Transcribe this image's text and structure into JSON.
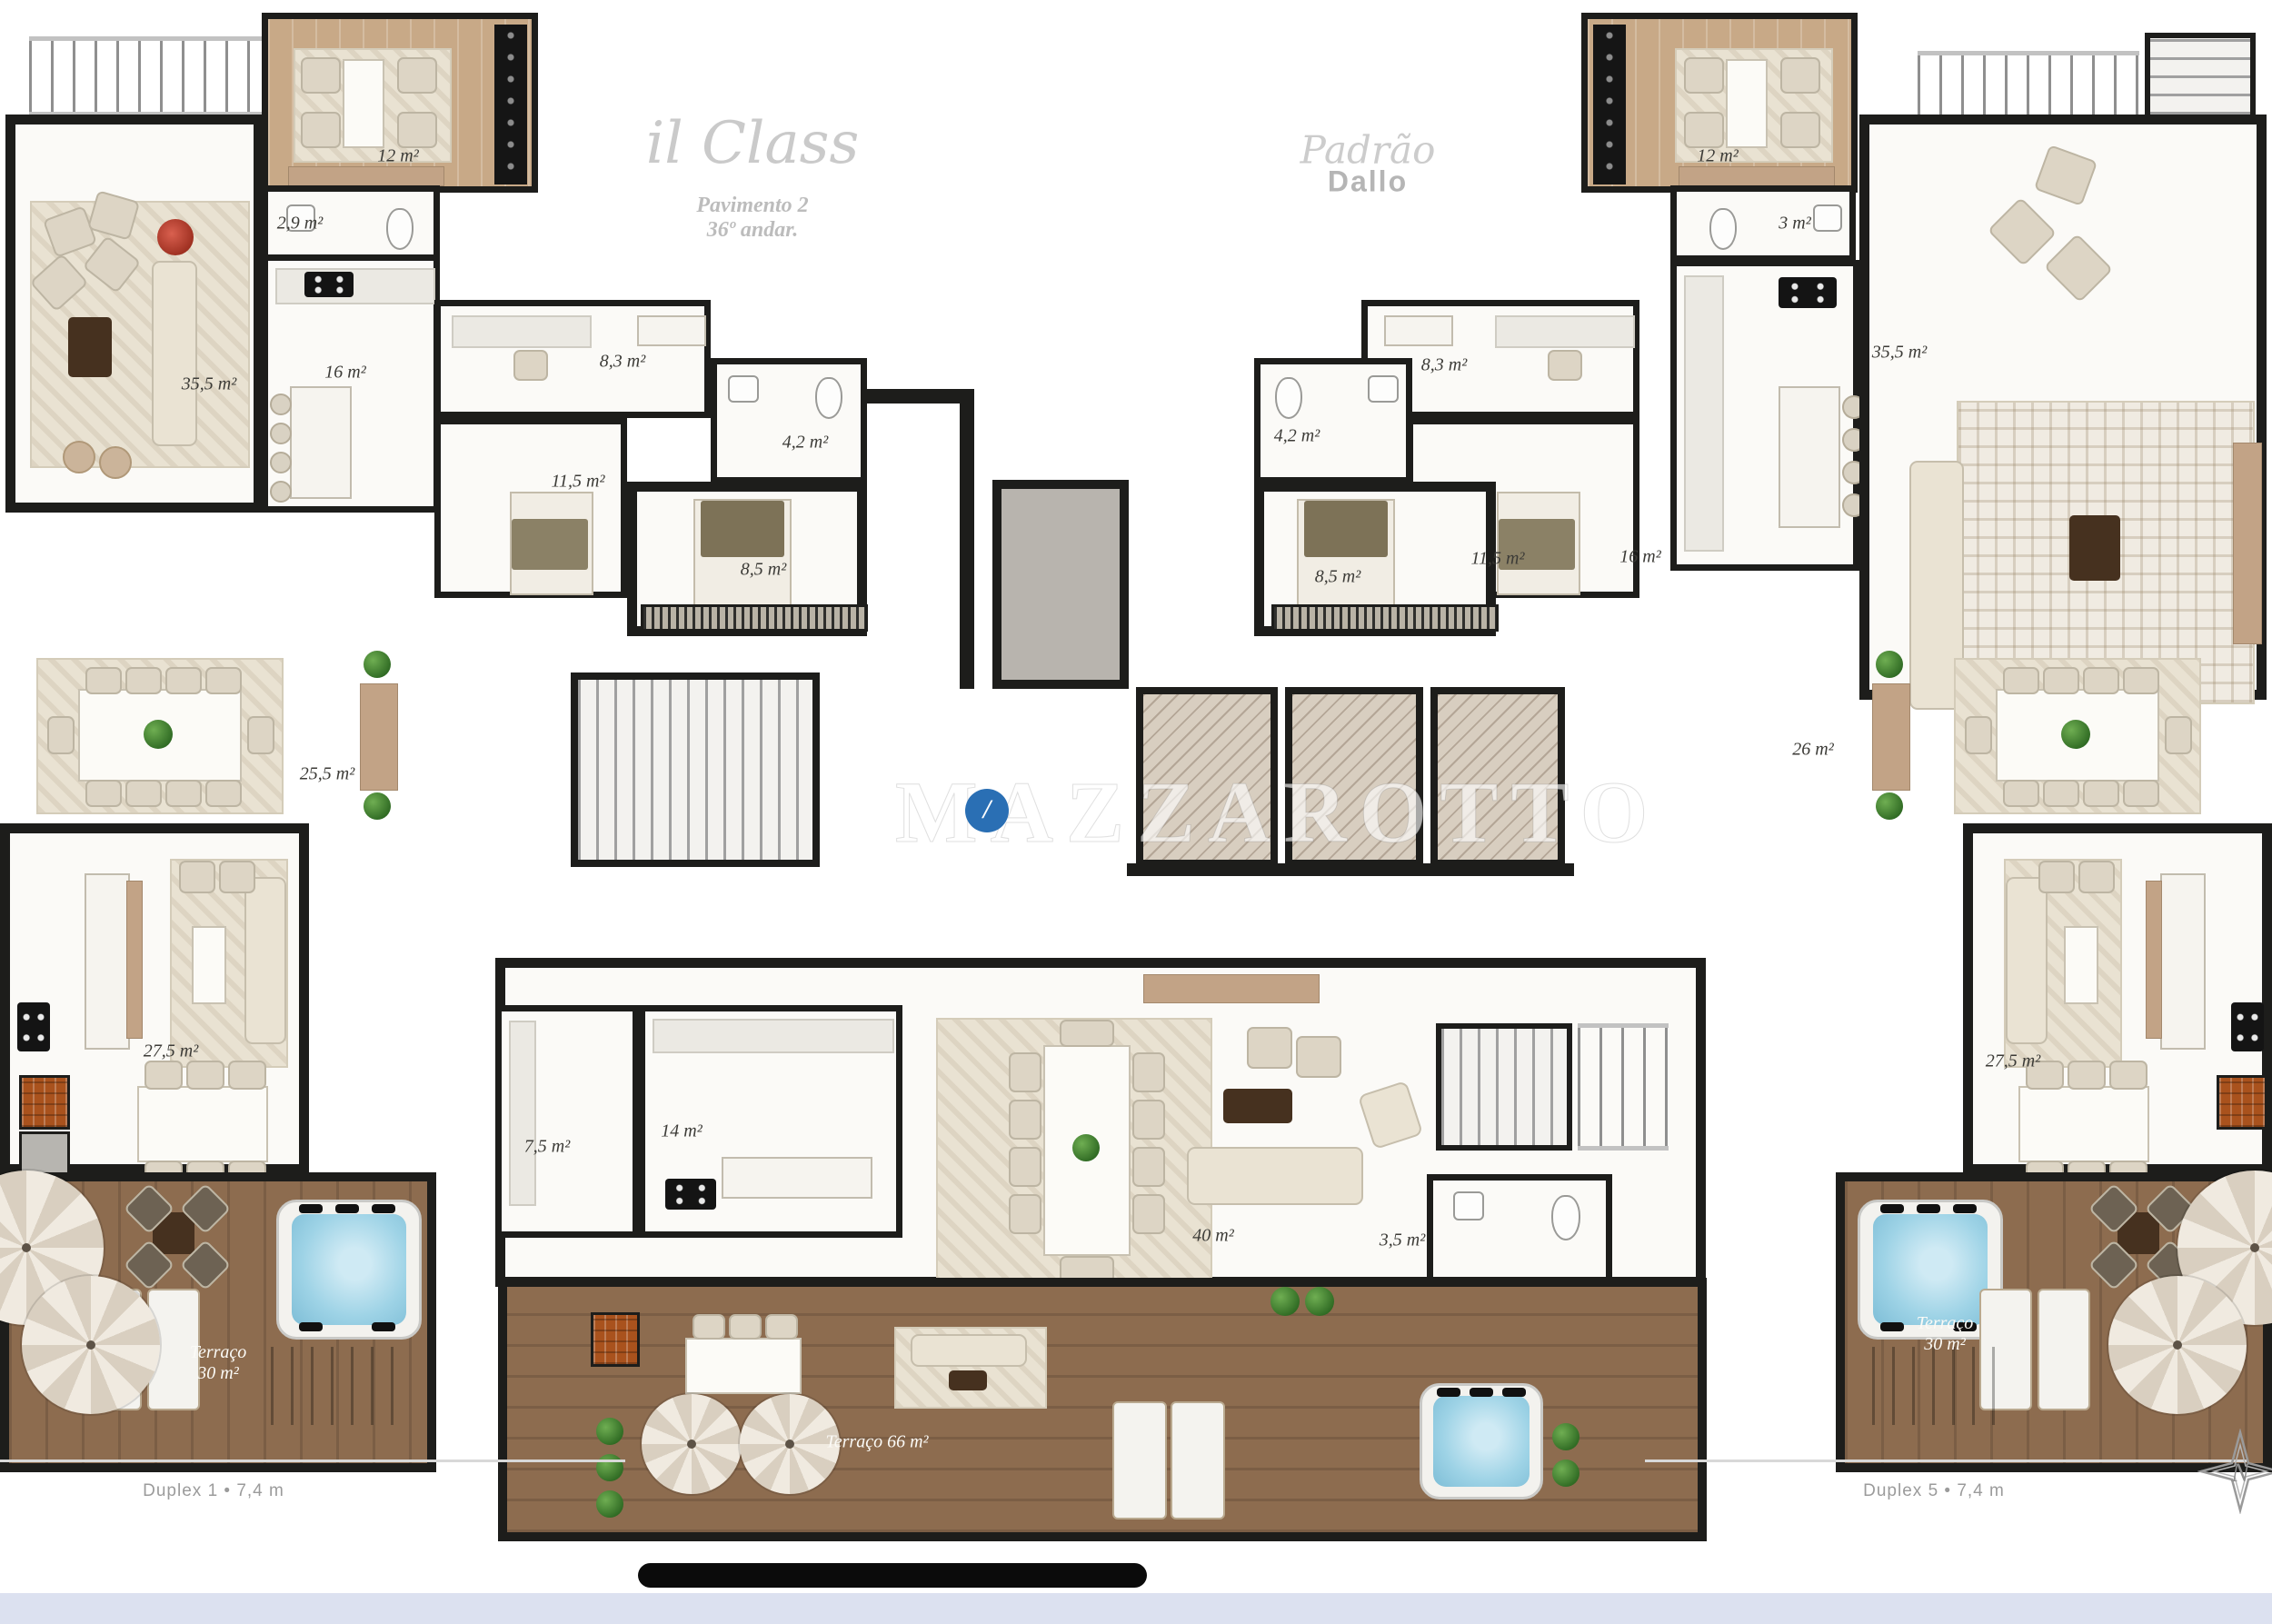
{
  "branding": {
    "logo_script": "il Class",
    "floor_label_line1": "Pavimento 2",
    "floor_label_line2": "36º andar.",
    "standard_script": "Padrão",
    "standard_bold": "Dallo",
    "watermark_text": "MAZZAROTTO",
    "watermark_badge_glyph": "/",
    "north_letter": "N"
  },
  "apartments": {
    "left": {
      "name": "Duplex 1",
      "footer_label": "Duplex 1 • 7,4 m",
      "rooms": {
        "lounge": "12 m²",
        "lavabo": "2,9 m²",
        "living": "35,5 m²",
        "kitchen": "16 m²",
        "office": "8,3 m²",
        "suite": "11,5 m²",
        "bath": "4,2 m²",
        "bedroom": "8,5 m²",
        "dining": "25,5 m²",
        "family": "27,5 m²"
      },
      "terrace": {
        "name": "Terraço",
        "area": "30 m²"
      }
    },
    "center": {
      "rooms": {
        "pantry": "7,5 m²",
        "kitchen": "14 m²",
        "living": "40 m²",
        "lavabo": "3,5 m²"
      },
      "terrace_label": "Terraço 66 m²"
    },
    "right": {
      "name": "Duplex 5",
      "footer_label": "Duplex 5 • 7,4 m",
      "rooms": {
        "lounge": "12 m²",
        "lavabo": "3 m²",
        "office": "8,3 m²",
        "bath": "4,2 m²",
        "suite": "11,5 m²",
        "bedroom": "8,5 m²",
        "kitchen": "16 m²",
        "living": "35,5 m²",
        "dining": "26 m²",
        "family": "27,5 m²"
      },
      "terrace": {
        "name": "Terraço",
        "area": "30 m²"
      }
    }
  },
  "colors": {
    "wall": "#1d1d1b",
    "wood_floor": "#c8a987",
    "deck_wood": "#8d6c4f",
    "jacuzzi_water": "#9ed3e6",
    "marble": "#d8cec0",
    "plant_green": "#3f7d2e",
    "label_ink": "#3c3b37",
    "muted_gray": "#9b9b9b",
    "watermark_blue": "#2a6fb4",
    "bottom_strip": "#dce1f0"
  }
}
